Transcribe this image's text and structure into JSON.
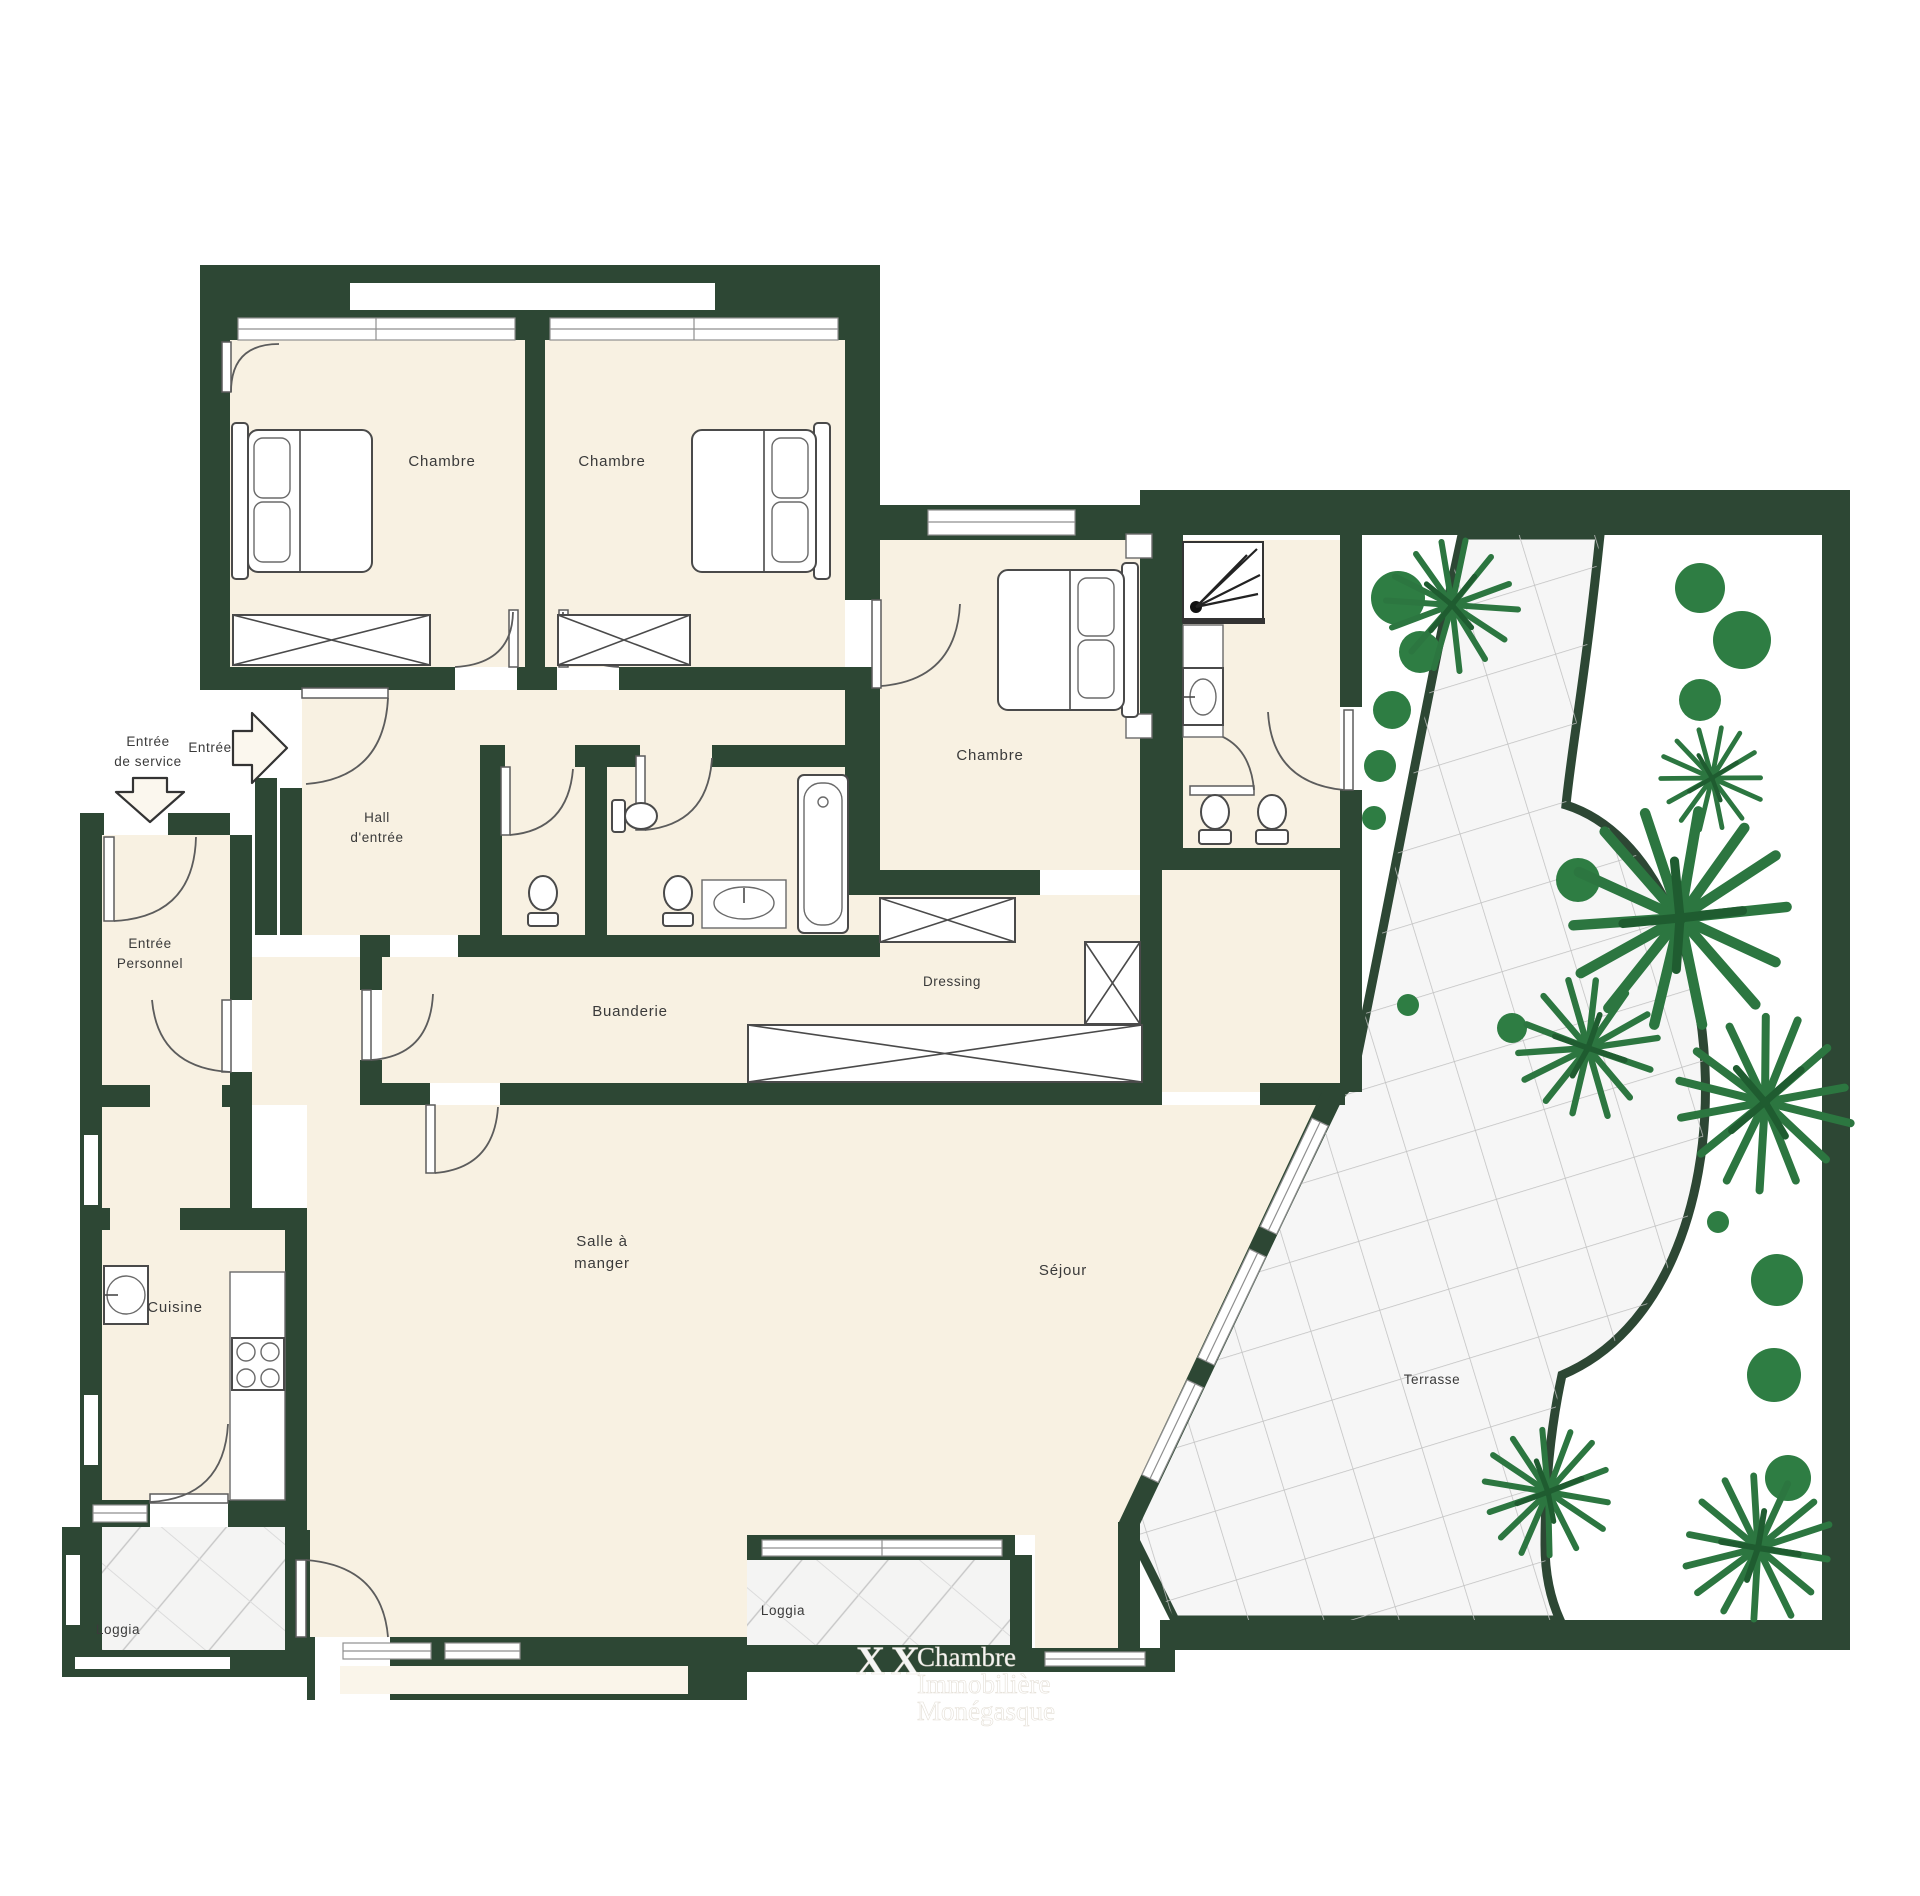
{
  "rooms": {
    "bedroom1": "Chambre",
    "bedroom2": "Chambre",
    "bedroom3": "Chambre",
    "hall": [
      "Hall",
      "d'entrée"
    ],
    "service_entrance": [
      "Entrée",
      "de service"
    ],
    "entrance": "Entrée",
    "staff_entrance": [
      "Entrée",
      "Personnel"
    ],
    "laundry": "Buanderie",
    "dressing": "Dressing",
    "kitchen": "Cuisine",
    "dining": [
      "Salle à",
      "manger"
    ],
    "living": "Séjour",
    "terrace": "Terrasse",
    "loggia_left": "Loggia",
    "loggia_center": "Loggia"
  },
  "watermark": {
    "logo": "XX",
    "lines": [
      "Chambre",
      "Immobilière",
      "Monégasque"
    ]
  },
  "colors": {
    "wall": "#2d4734",
    "floor": "#f8f1e2",
    "garden_green": "#2e7d43",
    "terrace_tile": "#f6f6f6",
    "background": "#ffffff"
  }
}
